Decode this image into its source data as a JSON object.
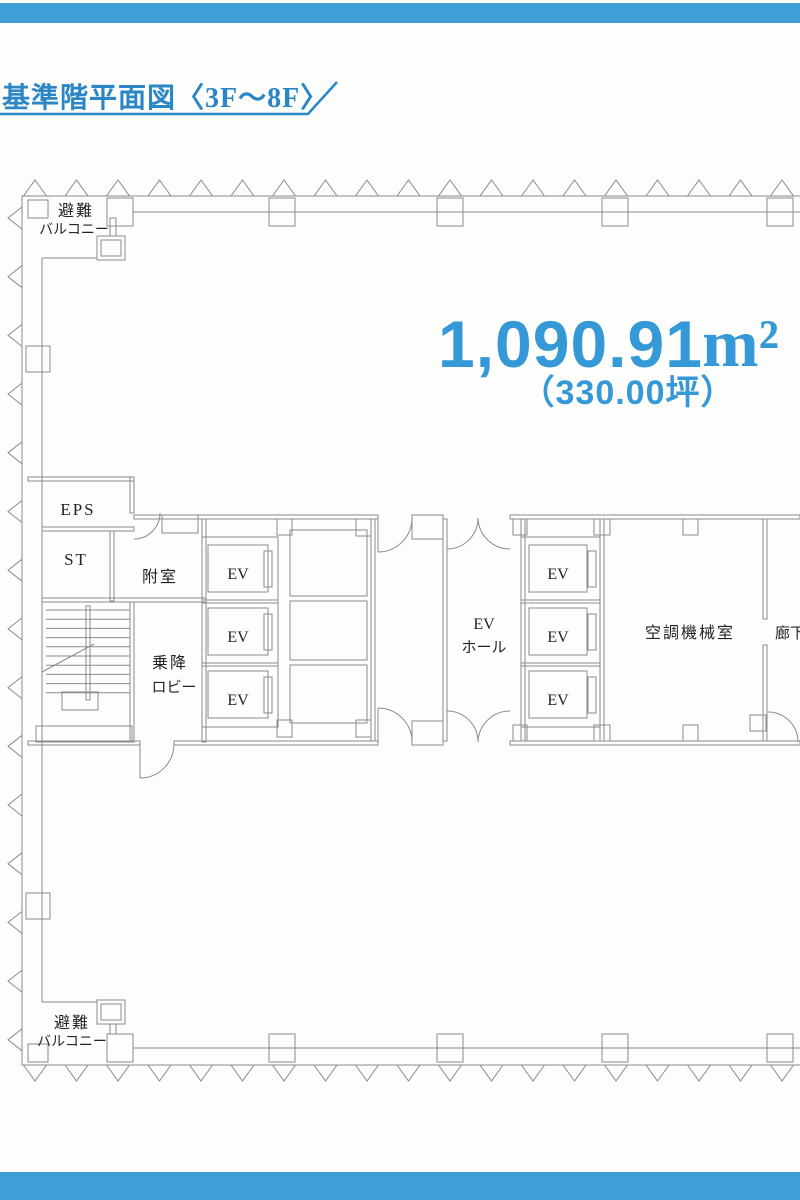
{
  "page": {
    "bar_color": "#3f9ed6",
    "title": {
      "text": "基準階平面図〈3F〜8F〉",
      "color": "#2b86c6"
    },
    "area": {
      "value": "1,090.91",
      "unit": "m²",
      "tsubo": "（330.00坪）",
      "color": "#3598d7"
    }
  },
  "plan": {
    "line_color": "#8b8b8b",
    "label_color": "#232323",
    "labels": {
      "balcony_top_1": "避難",
      "balcony_top_2": "バルコニー",
      "balcony_bottom_1": "避難",
      "balcony_bottom_2": "バルコニー",
      "eps": "EPS",
      "st": "ST",
      "anteroom": "附室",
      "lobby_1": "乗降",
      "lobby_2": "ロビー",
      "ev": "EV",
      "ev_hall_1": "EV",
      "ev_hall_2": "ホール",
      "hvac_room": "空調機械室",
      "corridor": "廊下"
    }
  }
}
